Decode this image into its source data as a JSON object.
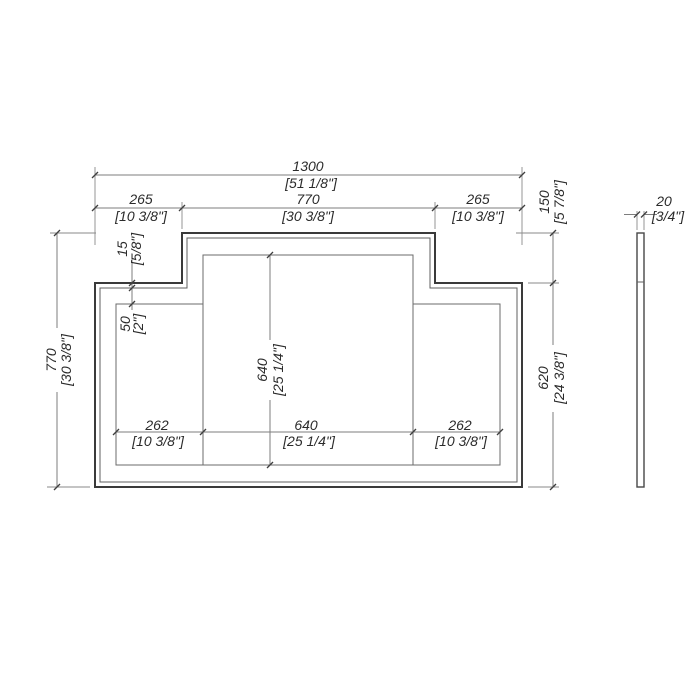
{
  "front_view": {
    "overall_width": {
      "mm": "1300",
      "in": "[51 1/8\"]"
    },
    "top_left_width": {
      "mm": "265",
      "in": "[10 3/8\"]"
    },
    "top_center_width": {
      "mm": "770",
      "in": "[30 3/8\"]"
    },
    "top_right_width": {
      "mm": "265",
      "in": "[10 3/8\"]"
    },
    "step_height": {
      "mm": "150",
      "in": "[5 7/8\"]"
    },
    "frame_offset": {
      "mm": "15",
      "in": "[5/8\"]"
    },
    "panel_inset": {
      "mm": "50",
      "in": "[2\"]"
    },
    "overall_height": {
      "mm": "770",
      "in": "[30 3/8\"]"
    },
    "side_height": {
      "mm": "620",
      "in": "[24 3/8\"]"
    },
    "center_panel_height": {
      "mm": "640",
      "in": "[25 1/4\"]"
    },
    "left_panel_width": {
      "mm": "262",
      "in": "[10 3/8\"]"
    },
    "center_panel_width": {
      "mm": "640",
      "in": "[25 1/4\"]"
    },
    "right_panel_width": {
      "mm": "262",
      "in": "[10 3/8\"]"
    }
  },
  "side_view": {
    "thickness": {
      "mm": "20",
      "in": "[3/4\"]"
    }
  },
  "colors": {
    "background": "#ffffff",
    "outline": "#3a3a3a",
    "thin_line": "#5f5f5f",
    "dimension_line": "#7d7d7d",
    "text": "#2b2b2b"
  }
}
